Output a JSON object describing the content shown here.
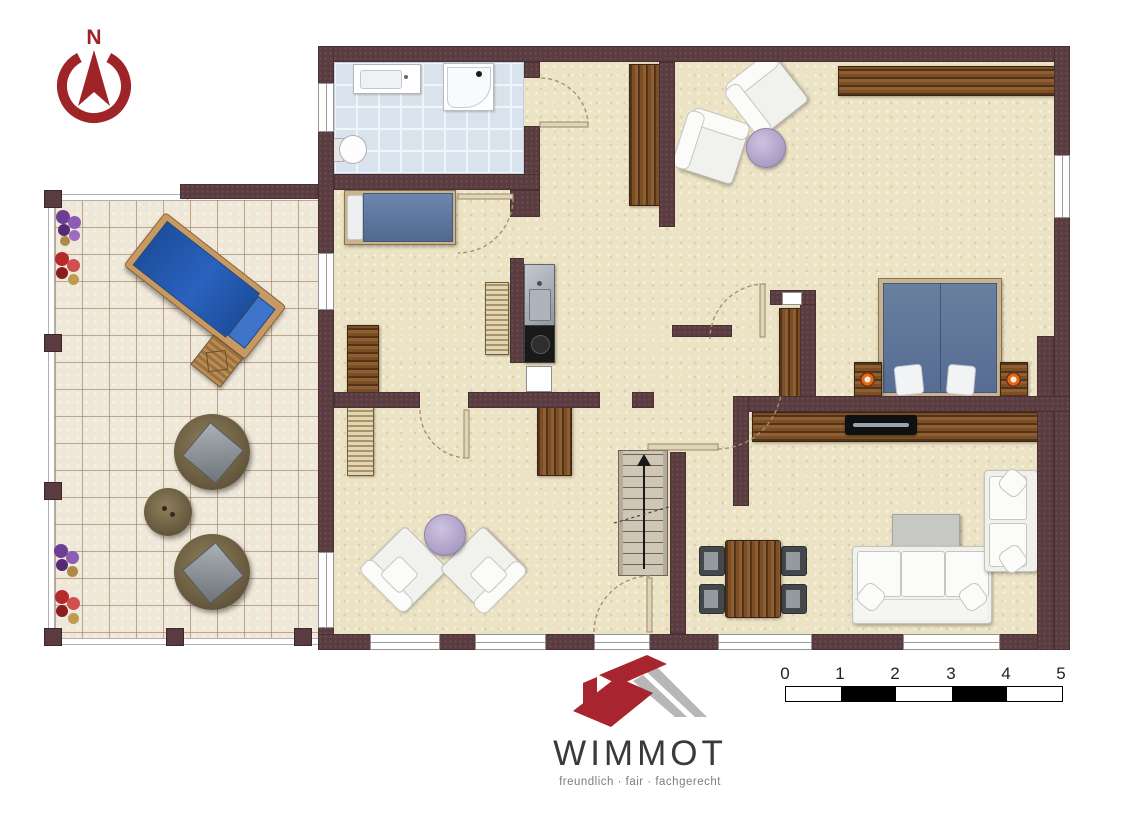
{
  "compass": {
    "label": "N"
  },
  "logo": {
    "name": "WIMMOT",
    "tagline": "freundlich · fair · fachgerecht"
  },
  "scale_bar": {
    "ticks": [
      "0",
      "1",
      "2",
      "3",
      "4",
      "5"
    ]
  },
  "colors": {
    "wall": "#5a3c40",
    "floor": "#ece3c5",
    "bathroom_tile": "#d9e3ed",
    "terrace_tile": "#efe8d9",
    "wood": "#7c5027",
    "bed_blue": "#62799f",
    "lounger_blue": "#2456a8",
    "lavender": "#a99dc4",
    "brand_red": "#a8242e",
    "logo_gray": "#b7b7b7"
  }
}
